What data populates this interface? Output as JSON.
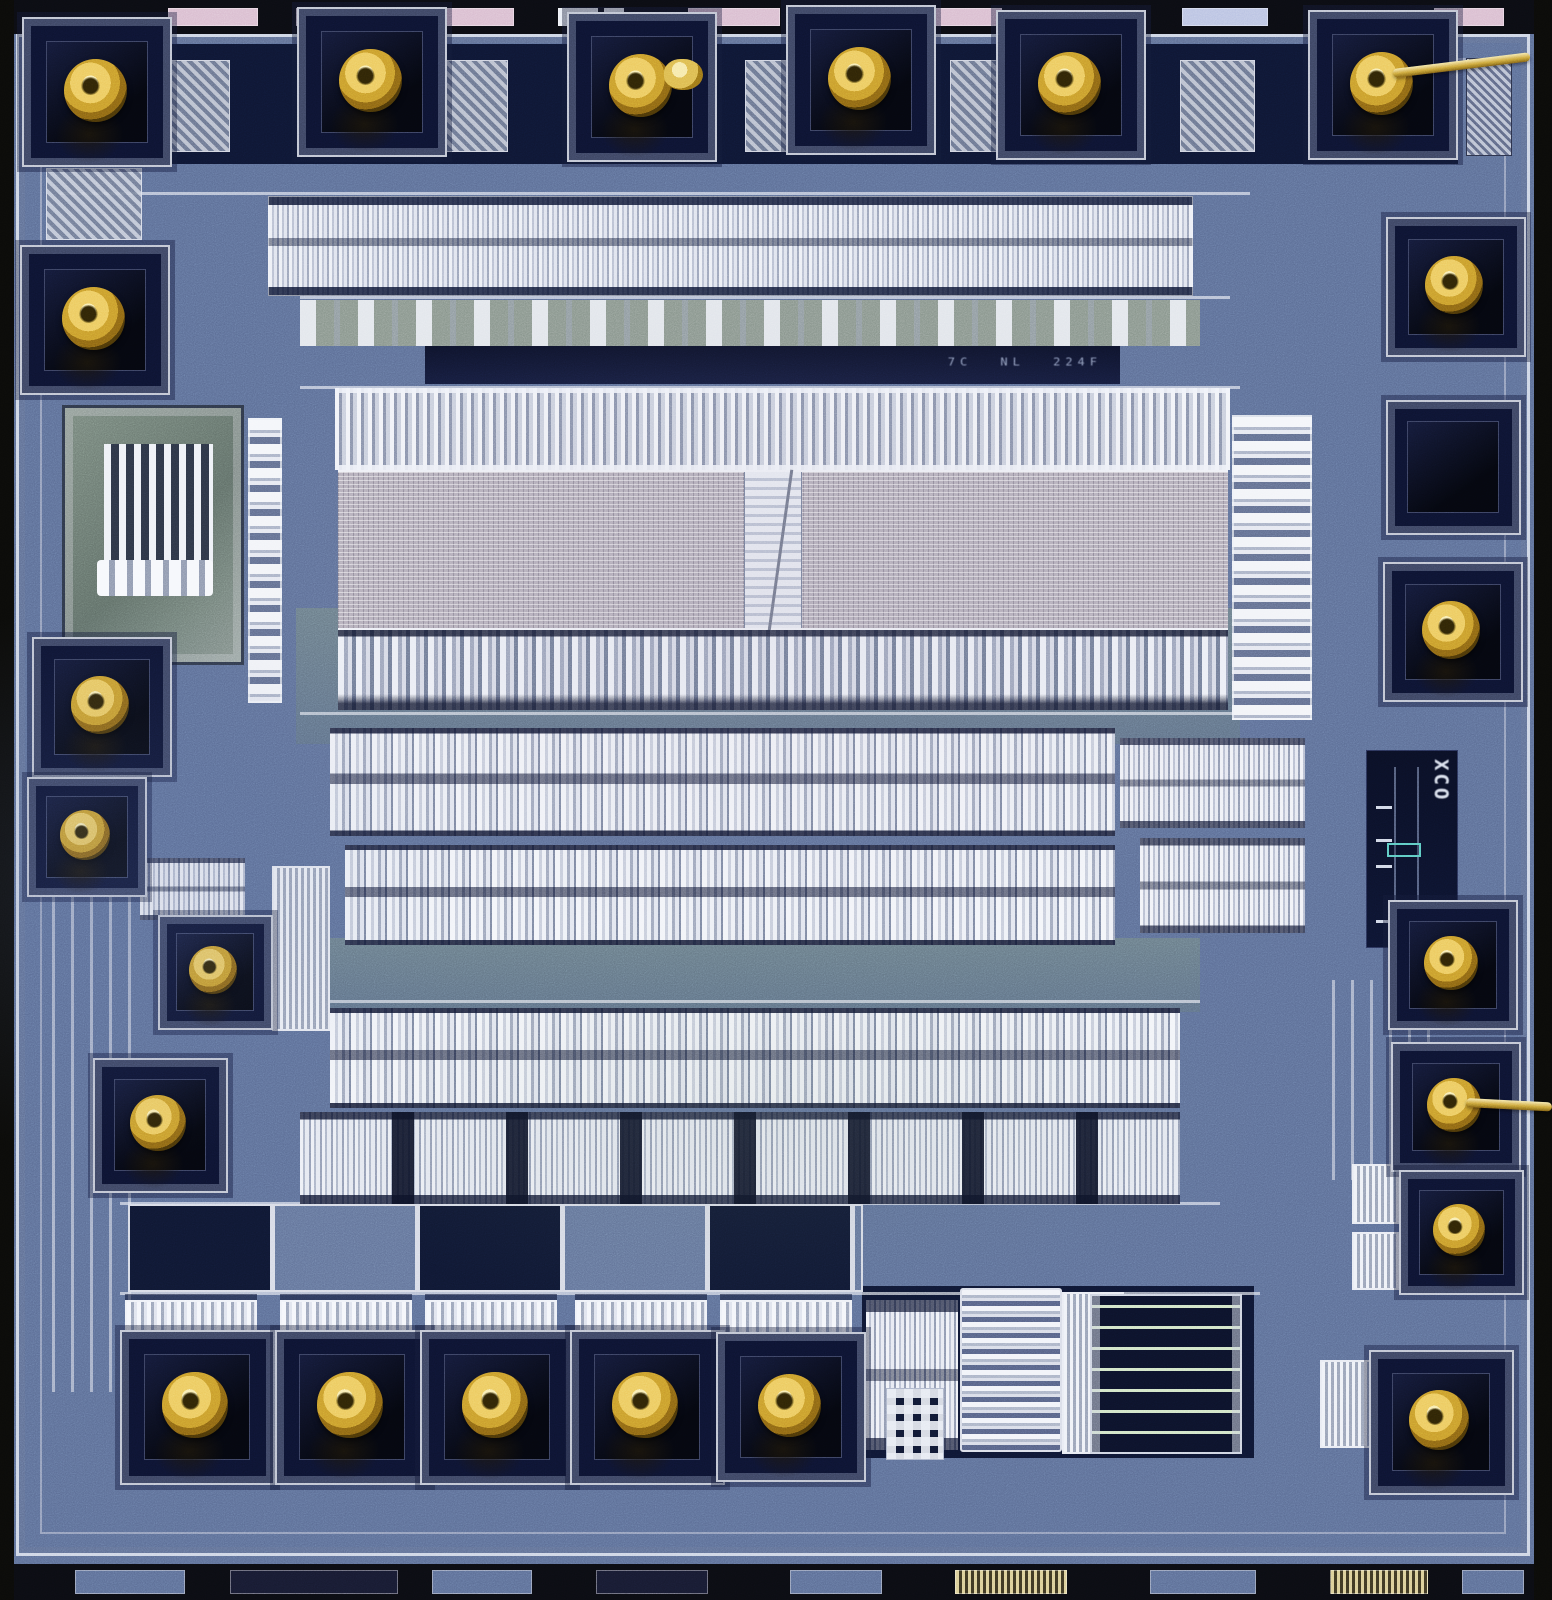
{
  "meta": {
    "description": "Microscope die photograph of an integrated circuit: blue passivated surface, perimeter gold ball-bond pads (several with torn bond wires), central ROM-style array with center seam, rows of standard cells, analog resistor/capacitor structures at bottom, dark test panel at right."
  },
  "markings": {
    "xco_label": "XCO",
    "part_marking": "7C NL 224F"
  },
  "palette": {
    "die_blue": "#5b6c94",
    "die_blue_light": "#8a9ac0",
    "die_blue_dark": "#39456b",
    "navy": "#0e1632",
    "metal_bright": "#eef1f8",
    "metal_mid": "#aab3c9",
    "green_gray": "#829084",
    "array_gray": "#b2acb8",
    "gold": "#d4a93c",
    "gold_light": "#f4e08c",
    "gold_dark": "#6f4f0f",
    "scribe_black": "#0b0b09",
    "teal_outline": "#59c8c0"
  },
  "regions": [
    {
      "type": "navy",
      "x": 60,
      "y": 44,
      "w": 1398,
      "h": 120,
      "name": "io-ring-field"
    },
    {
      "type": "band-green",
      "x": 296,
      "y": 608,
      "w": 944,
      "h": 136,
      "name": "green-tint-band"
    },
    {
      "type": "band-green",
      "x": 300,
      "y": 938,
      "w": 900,
      "h": 74,
      "name": "green-tint-band"
    },
    {
      "type": "navy",
      "x": 862,
      "y": 1286,
      "w": 392,
      "h": 172,
      "name": "analog-field"
    },
    {
      "type": "traces-v",
      "x": 36,
      "y": 752,
      "w": 96,
      "h": 640,
      "name": "metal-trace-bundle"
    },
    {
      "type": "traces-v",
      "x": 1316,
      "y": 980,
      "w": 120,
      "h": 200,
      "name": "metal-trace-bundle"
    },
    {
      "type": "hline",
      "x": 60,
      "y": 192,
      "w": 1190,
      "h": 3,
      "name": "metal-bus-line"
    },
    {
      "type": "hline",
      "x": 300,
      "y": 296,
      "w": 930,
      "h": 3,
      "name": "metal-bus-line"
    },
    {
      "type": "hline",
      "x": 300,
      "y": 386,
      "w": 940,
      "h": 3,
      "name": "metal-bus-line"
    },
    {
      "type": "hline",
      "x": 300,
      "y": 712,
      "w": 940,
      "h": 3,
      "name": "metal-bus-line"
    },
    {
      "type": "hline",
      "x": 300,
      "y": 1000,
      "w": 900,
      "h": 3,
      "name": "metal-bus-line"
    },
    {
      "type": "hline",
      "x": 120,
      "y": 1202,
      "w": 1100,
      "h": 3,
      "name": "metal-bus-line"
    },
    {
      "type": "hline",
      "x": 120,
      "y": 1292,
      "w": 1140,
      "h": 3,
      "name": "metal-bus-line"
    },
    {
      "type": "logic-fine",
      "x": 268,
      "y": 196,
      "w": 925,
      "h": 100,
      "name": "standard-cell-row"
    },
    {
      "type": "logic-sparse",
      "x": 300,
      "y": 300,
      "w": 900,
      "h": 46,
      "name": "sparse-cell-band"
    },
    {
      "type": "drivers-top",
      "x": 335,
      "y": 388,
      "w": 895,
      "h": 82,
      "name": "column-driver-row"
    },
    {
      "type": "array",
      "x": 338,
      "y": 470,
      "w": 890,
      "h": 160,
      "name": "rom-array"
    },
    {
      "type": "drivers-bottom",
      "x": 338,
      "y": 630,
      "w": 890,
      "h": 80,
      "name": "sense-driver-row"
    },
    {
      "type": "cells-bright",
      "x": 330,
      "y": 728,
      "w": 785,
      "h": 108,
      "name": "standard-cell-row"
    },
    {
      "type": "cells-bright",
      "x": 345,
      "y": 845,
      "w": 770,
      "h": 100,
      "name": "standard-cell-row"
    },
    {
      "type": "cells-bright",
      "x": 330,
      "y": 1008,
      "w": 850,
      "h": 100,
      "name": "standard-cell-row"
    },
    {
      "type": "buffers",
      "x": 300,
      "y": 1112,
      "w": 880,
      "h": 92,
      "name": "output-buffer-row"
    },
    {
      "type": "cells-small",
      "x": 1120,
      "y": 738,
      "w": 185,
      "h": 90,
      "name": "cell-cluster"
    },
    {
      "type": "cells-small",
      "x": 1140,
      "y": 838,
      "w": 165,
      "h": 95,
      "name": "cell-cluster"
    },
    {
      "type": "ladder",
      "x": 1232,
      "y": 415,
      "w": 80,
      "h": 305,
      "name": "row-decoder-ladder"
    },
    {
      "type": "ladder",
      "x": 248,
      "y": 418,
      "w": 34,
      "h": 285,
      "name": "row-decoder-ladder"
    },
    {
      "type": "osc",
      "x": 62,
      "y": 405,
      "w": 182,
      "h": 260,
      "name": "analog-cell-block"
    },
    {
      "type": "test",
      "x": 46,
      "y": 168,
      "w": 96,
      "h": 72,
      "name": "test-structure"
    },
    {
      "type": "test",
      "x": 168,
      "y": 60,
      "w": 62,
      "h": 92,
      "name": "test-structure"
    },
    {
      "type": "test",
      "x": 430,
      "y": 60,
      "w": 78,
      "h": 92,
      "name": "test-structure"
    },
    {
      "type": "test",
      "x": 745,
      "y": 60,
      "w": 80,
      "h": 92,
      "name": "test-structure"
    },
    {
      "type": "test",
      "x": 950,
      "y": 60,
      "w": 80,
      "h": 92,
      "name": "test-structure"
    },
    {
      "type": "test",
      "x": 1180,
      "y": 60,
      "w": 75,
      "h": 92,
      "name": "test-structure"
    },
    {
      "type": "logo-tex",
      "x": 1466,
      "y": 58,
      "w": 46,
      "h": 98,
      "name": "logo-mark"
    },
    {
      "type": "cap-v",
      "x": 272,
      "y": 866,
      "w": 58,
      "h": 165,
      "name": "poly-capacitor"
    },
    {
      "type": "cells-small",
      "x": 140,
      "y": 858,
      "w": 105,
      "h": 62,
      "name": "cell-cluster"
    },
    {
      "type": "panel-grid",
      "x": 128,
      "y": 1204,
      "w": 735,
      "h": 88,
      "name": "panel-grid"
    },
    {
      "type": "driver-stripes",
      "x": 125,
      "y": 1300,
      "w": 132,
      "h": 62,
      "name": "driver-fets"
    },
    {
      "type": "driver-stripes",
      "x": 280,
      "y": 1300,
      "w": 132,
      "h": 62,
      "name": "driver-fets"
    },
    {
      "type": "driver-stripes",
      "x": 425,
      "y": 1300,
      "w": 132,
      "h": 62,
      "name": "driver-fets"
    },
    {
      "type": "driver-stripes",
      "x": 575,
      "y": 1300,
      "w": 132,
      "h": 62,
      "name": "driver-fets"
    },
    {
      "type": "driver-stripes",
      "x": 720,
      "y": 1300,
      "w": 132,
      "h": 62,
      "name": "driver-fets"
    },
    {
      "type": "cells-small",
      "x": 866,
      "y": 1300,
      "w": 92,
      "h": 150,
      "name": "analog-logic"
    },
    {
      "type": "meander",
      "x": 960,
      "y": 1288,
      "w": 102,
      "h": 164,
      "name": "meander-resistor"
    },
    {
      "type": "contact-grid",
      "x": 886,
      "y": 1388,
      "w": 58,
      "h": 72,
      "name": "contact-array"
    },
    {
      "type": "cap-v",
      "x": 1062,
      "y": 1292,
      "w": 62,
      "h": 162,
      "name": "poly-capacitor"
    },
    {
      "type": "serpentine",
      "x": 1090,
      "y": 1294,
      "w": 152,
      "h": 160,
      "name": "serpentine-resistor"
    },
    {
      "type": "cap-v",
      "x": 1352,
      "y": 1164,
      "w": 76,
      "h": 60,
      "name": "poly-capacitor"
    },
    {
      "type": "cap-v",
      "x": 1352,
      "y": 1232,
      "w": 76,
      "h": 58,
      "name": "poly-capacitor"
    },
    {
      "type": "cap-v",
      "x": 1320,
      "y": 1360,
      "w": 78,
      "h": 88,
      "name": "poly-capacitor"
    }
  ],
  "pads": [
    {
      "cx": 97,
      "cy": 92,
      "s": 150,
      "ball": true
    },
    {
      "cx": 372,
      "cy": 82,
      "s": 150,
      "ball": true
    },
    {
      "cx": 642,
      "cy": 87,
      "s": 150,
      "ball": true,
      "blob": true
    },
    {
      "cx": 861,
      "cy": 80,
      "s": 150,
      "ball": true
    },
    {
      "cx": 1071,
      "cy": 85,
      "s": 150,
      "ball": true
    },
    {
      "cx": 1383,
      "cy": 85,
      "s": 150,
      "ball": true,
      "wire": {
        "dx": 10,
        "dy": -16,
        "len": 138,
        "rot": -7
      }
    },
    {
      "cx": 95,
      "cy": 320,
      "s": 150,
      "ball": true
    },
    {
      "cx": 102,
      "cy": 707,
      "s": 140,
      "ball": true
    },
    {
      "cx": 87,
      "cy": 837,
      "s": 120,
      "ball": true
    },
    {
      "cx": 215,
      "cy": 972,
      "s": 115,
      "ball": true
    },
    {
      "cx": 160,
      "cy": 1125,
      "s": 135,
      "ball": true
    },
    {
      "cx": 197,
      "cy": 1407,
      "s": 155,
      "ball": true
    },
    {
      "cx": 352,
      "cy": 1407,
      "s": 155,
      "ball": true
    },
    {
      "cx": 497,
      "cy": 1407,
      "s": 155,
      "ball": true
    },
    {
      "cx": 647,
      "cy": 1407,
      "s": 155,
      "ball": true
    },
    {
      "cx": 791,
      "cy": 1407,
      "s": 150,
      "ball": true
    },
    {
      "cx": 1456,
      "cy": 287,
      "s": 140,
      "ball": true
    },
    {
      "cx": 1453,
      "cy": 467,
      "s": 135,
      "ball": false
    },
    {
      "cx": 1453,
      "cy": 632,
      "s": 140,
      "ball": true
    },
    {
      "cx": 1453,
      "cy": 965,
      "s": 130,
      "ball": true
    },
    {
      "cx": 1456,
      "cy": 1107,
      "s": 130,
      "ball": true,
      "wire": {
        "dx": 10,
        "dy": -9,
        "len": 86,
        "rot": 3
      }
    },
    {
      "cx": 1461,
      "cy": 1232,
      "s": 125,
      "ball": true
    },
    {
      "cx": 1441,
      "cy": 1422,
      "s": 145,
      "ball": true
    }
  ],
  "scribe_marks": {
    "top": [
      {
        "x": 168,
        "w": 90,
        "c": "pink"
      },
      {
        "x": 296,
        "w": 78,
        "c": "pink"
      },
      {
        "x": 428,
        "w": 86,
        "c": "pink"
      },
      {
        "x": 558,
        "w": 40,
        "c": "light"
      },
      {
        "x": 604,
        "w": 20,
        "c": "light"
      },
      {
        "x": 688,
        "w": 92,
        "c": "pink"
      },
      {
        "x": 930,
        "w": 72,
        "c": "pink"
      },
      {
        "x": 1182,
        "w": 86,
        "c": "lav"
      },
      {
        "x": 1434,
        "w": 70,
        "c": "pink"
      }
    ],
    "bottom": [
      {
        "x": 75,
        "w": 110,
        "c": "blue"
      },
      {
        "x": 230,
        "w": 168,
        "c": "dark"
      },
      {
        "x": 432,
        "w": 100,
        "c": "blue"
      },
      {
        "x": 596,
        "w": 112,
        "c": "dark"
      },
      {
        "x": 790,
        "w": 92,
        "c": "blue"
      },
      {
        "x": 955,
        "w": 112,
        "c": "striped"
      },
      {
        "x": 1150,
        "w": 106,
        "c": "blue"
      },
      {
        "x": 1330,
        "w": 98,
        "c": "striped"
      },
      {
        "x": 1462,
        "w": 62,
        "c": "blue"
      }
    ]
  }
}
